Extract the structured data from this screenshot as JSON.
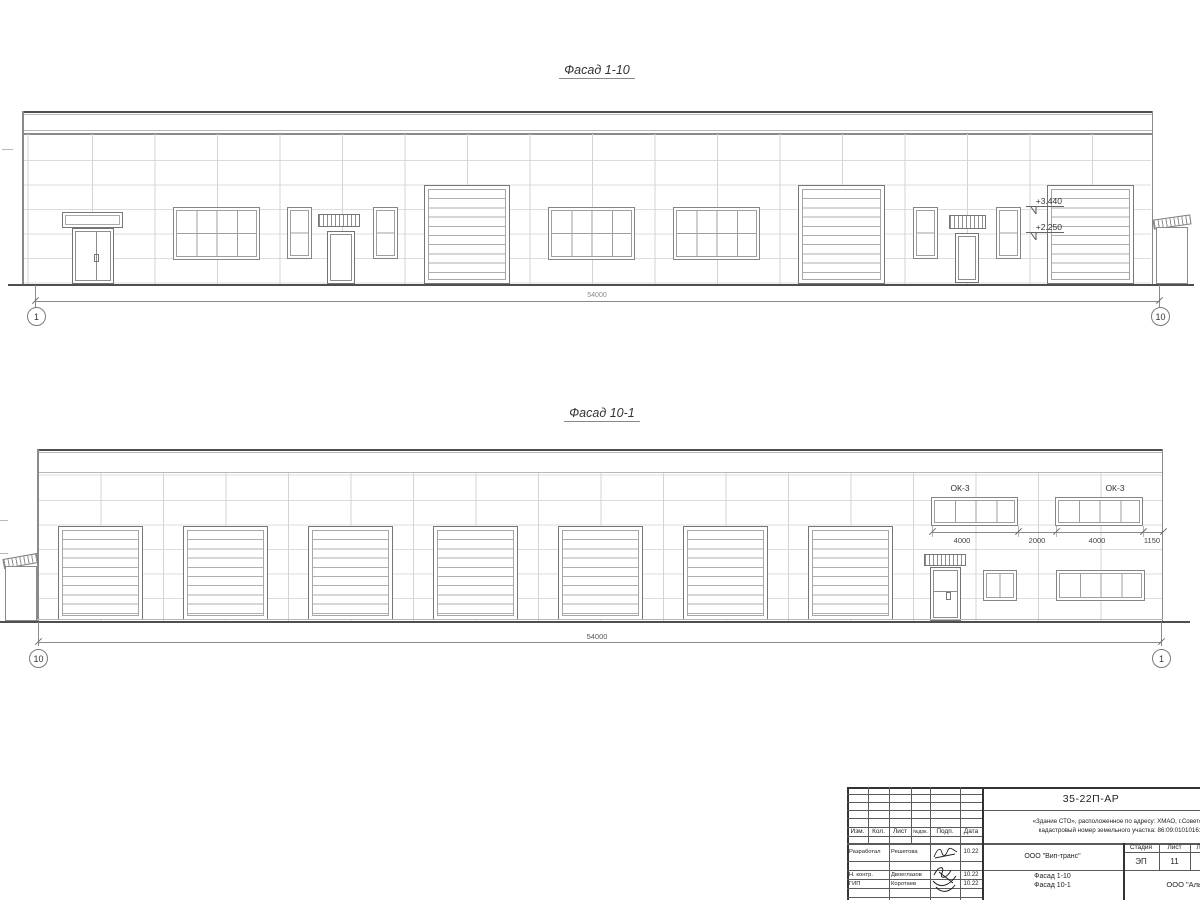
{
  "drawing": {
    "facade_top": {
      "title": "Фасад 1-10",
      "total_dim": "54000",
      "axis_left": "1",
      "axis_right": "10",
      "elevation_upper": "+3.440",
      "elevation_lower": "+2.250"
    },
    "facade_bottom": {
      "title": "Фасад 10-1",
      "total_dim": "54000",
      "axis_left": "10",
      "axis_right": "1",
      "window_label_1": "ОК-3",
      "window_label_2": "ОК-3",
      "dims": [
        "4000",
        "2000",
        "4000",
        "1150"
      ]
    }
  },
  "title_block": {
    "doc_number": "35-22П-АР",
    "project_line1": "«Здание СТО», расположенное по адресу: ХМАО, г.Советский,",
    "project_line2": "кадастровый номер земельного участка: 86:09:0101016:15",
    "columns": [
      "Изм.",
      "Кол.",
      "Лист",
      "№док.",
      "Подп.",
      "Дата"
    ],
    "signers": [
      {
        "role": "Разработал",
        "name": "Решетова",
        "date": "10.22"
      },
      {
        "role": "Н. контр.",
        "name": "Двоеглазов",
        "date": "10.22"
      },
      {
        "role": "ГИП",
        "name": "Коротаев",
        "date": "10.22"
      }
    ],
    "client": "ООО \"Вип-транс\"",
    "stage_label": "Стадия",
    "sheet_label": "Лист",
    "sheets_label": "Листов",
    "stage": "ЭП",
    "sheet": "11",
    "subject_line1": "Фасад 1-10",
    "subject_line2": "Фасад 10-1",
    "company": "ООО \"Альянс\""
  },
  "colors": {
    "outline": "#4f4f4f",
    "panel_joint": "#d4d4d4",
    "text": "#333333"
  }
}
